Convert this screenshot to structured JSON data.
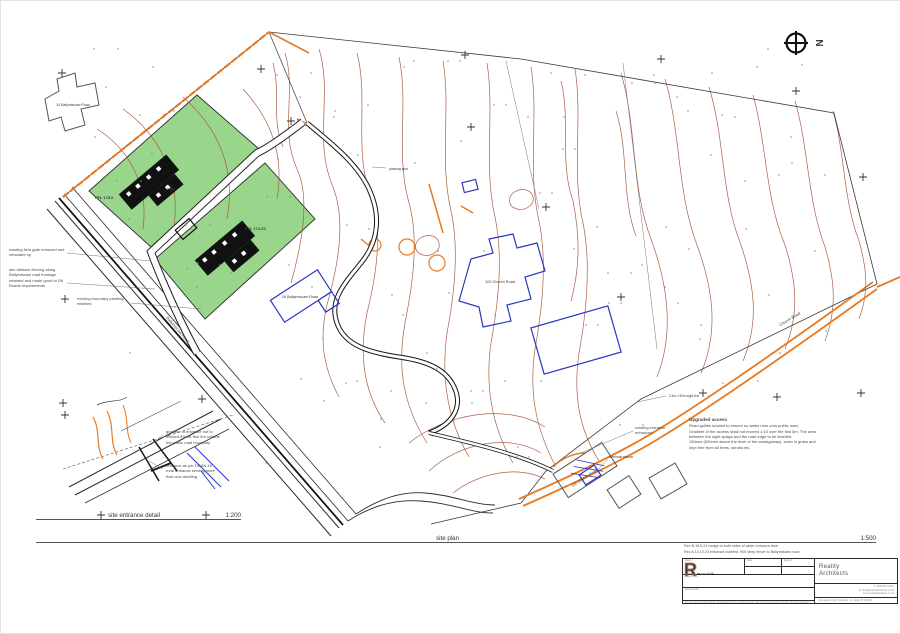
{
  "colors": {
    "contour": "#a8583f",
    "boundary_orange": "#e87a22",
    "plot_green": "#8ed27f",
    "building_blue": "#2b35c0",
    "logo_copper": "#c8825f",
    "line_black": "#2b2b2b"
  },
  "north": {
    "label": "N"
  },
  "plan": {
    "title": "site plan",
    "scale": "1:500",
    "labels": {
      "house24": "24 Ballymiscaw Road",
      "house28": "28 Ballymiscaw Road",
      "house109": "109 Church Road",
      "house100": "100 Church Road",
      "ffl1": "FFL 175.0",
      "ffl2": "FFL 174.25",
      "passing_spot": "passing spot",
      "road_left": "Ballymiscaw Road",
      "road_right": "Church Road",
      "sight_line": "2.4m x 90m sight line",
      "overhead_electric": "overhead electric"
    },
    "notes": {
      "field_gate": "existing field gate removed and relocated up",
      "ash_dieback": "ash dieback fencing along Ballymiscaw road frontage retained and made good to DfI Roads requirements",
      "boundary_planting": "existing boundary planting retained",
      "entrance_enhanced": "existing entrance enhanced",
      "upgraded_title": "Upgraded access",
      "upgraded_body_1": "Road gullies located to ensure no water runs onto public road.",
      "upgraded_body_2": "Gradient of the access shall not exceed 1:10 over the first 5m. The area between the sight splays and the road edge to be levelled.",
      "upgraded_body_3": "150mm (600mm above the level of the carriageway), sown in grass and kept free from all trees, shrubs etc."
    }
  },
  "entrance_detail": {
    "title": "site entrance detail",
    "scale": "1:200",
    "note_gradient": "gradient of entrance not to exceed 8% for first 5m outside the public road boundary",
    "note_dcan": "entrance as per DCAN 15 rural entrance serving more than one dwelling"
  },
  "revisions": [
    {
      "text": "Rev B  19.6.24  hedge to both sides of wider entrance lane"
    },
    {
      "text": "Rev A  14.10.23  entrance clarified. 900 deep fence to Ballymiscaw road"
    }
  ],
  "title_block": {
    "client_label": "client",
    "client": "Nagy Darwish",
    "date_label": "date",
    "date": "",
    "dwg_label": "dwg no",
    "dwg": "",
    "scale_label": "scale",
    "scale": "1:500 @ A1",
    "rev_label": "rev",
    "rev": "B",
    "project_label": "project",
    "project": "109 Church Road, Holywood",
    "drawing_label": "drawing title",
    "drawing": "site plan",
    "disclaimer": "Do not scale from this drawing. All dimensions to be checked on site prior to commencement of works. Any discrepancies to be reported to the architect.",
    "firm_name_1": "Reality",
    "firm_name_2": "Architects",
    "logo_letter": "R",
    "contact_1": "T.  028 9042 4470",
    "contact_2": "E.  info@realityarchitects.co.uk",
    "contact_3": "www.realityarchitects.co.uk",
    "address": "4 Deramore Park, Holywood, Co. Down  BT18 9NR"
  }
}
